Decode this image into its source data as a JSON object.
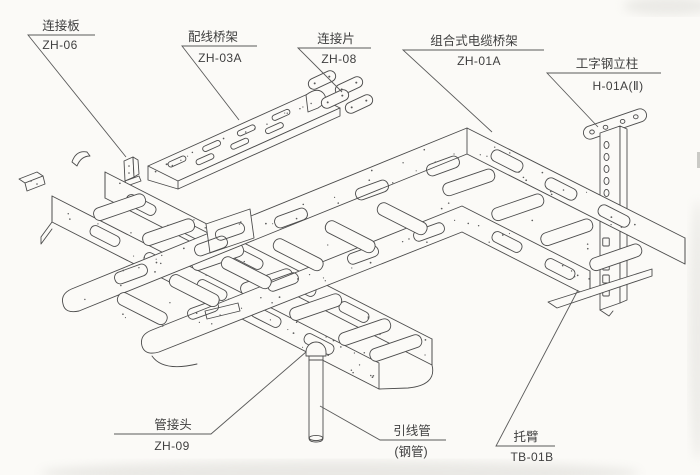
{
  "figure": {
    "type": "isometric-assembly-diagram",
    "subject": "组合式电缆桥架安装示意",
    "paper_color": "#fbfaf7",
    "line_color": "#4c4c4c"
  },
  "labels": {
    "zh06": {
      "title": "连接板",
      "code": "ZH-06"
    },
    "zh03a": {
      "title": "配线桥架",
      "code": "ZH-03A"
    },
    "zh08": {
      "title": "连接片",
      "code": "ZH-08"
    },
    "zh01a": {
      "title": "组合式电缆桥架",
      "code": "ZH-01A"
    },
    "h01a": {
      "title": "工字钢立柱",
      "code": "H-01A(Ⅱ)"
    },
    "zh09": {
      "title": "管接头",
      "code": "ZH-09"
    },
    "pipe": {
      "title": "引线管",
      "code": "(钢管)"
    },
    "tb01b": {
      "title": "托臂",
      "code": "TB-01B"
    }
  }
}
